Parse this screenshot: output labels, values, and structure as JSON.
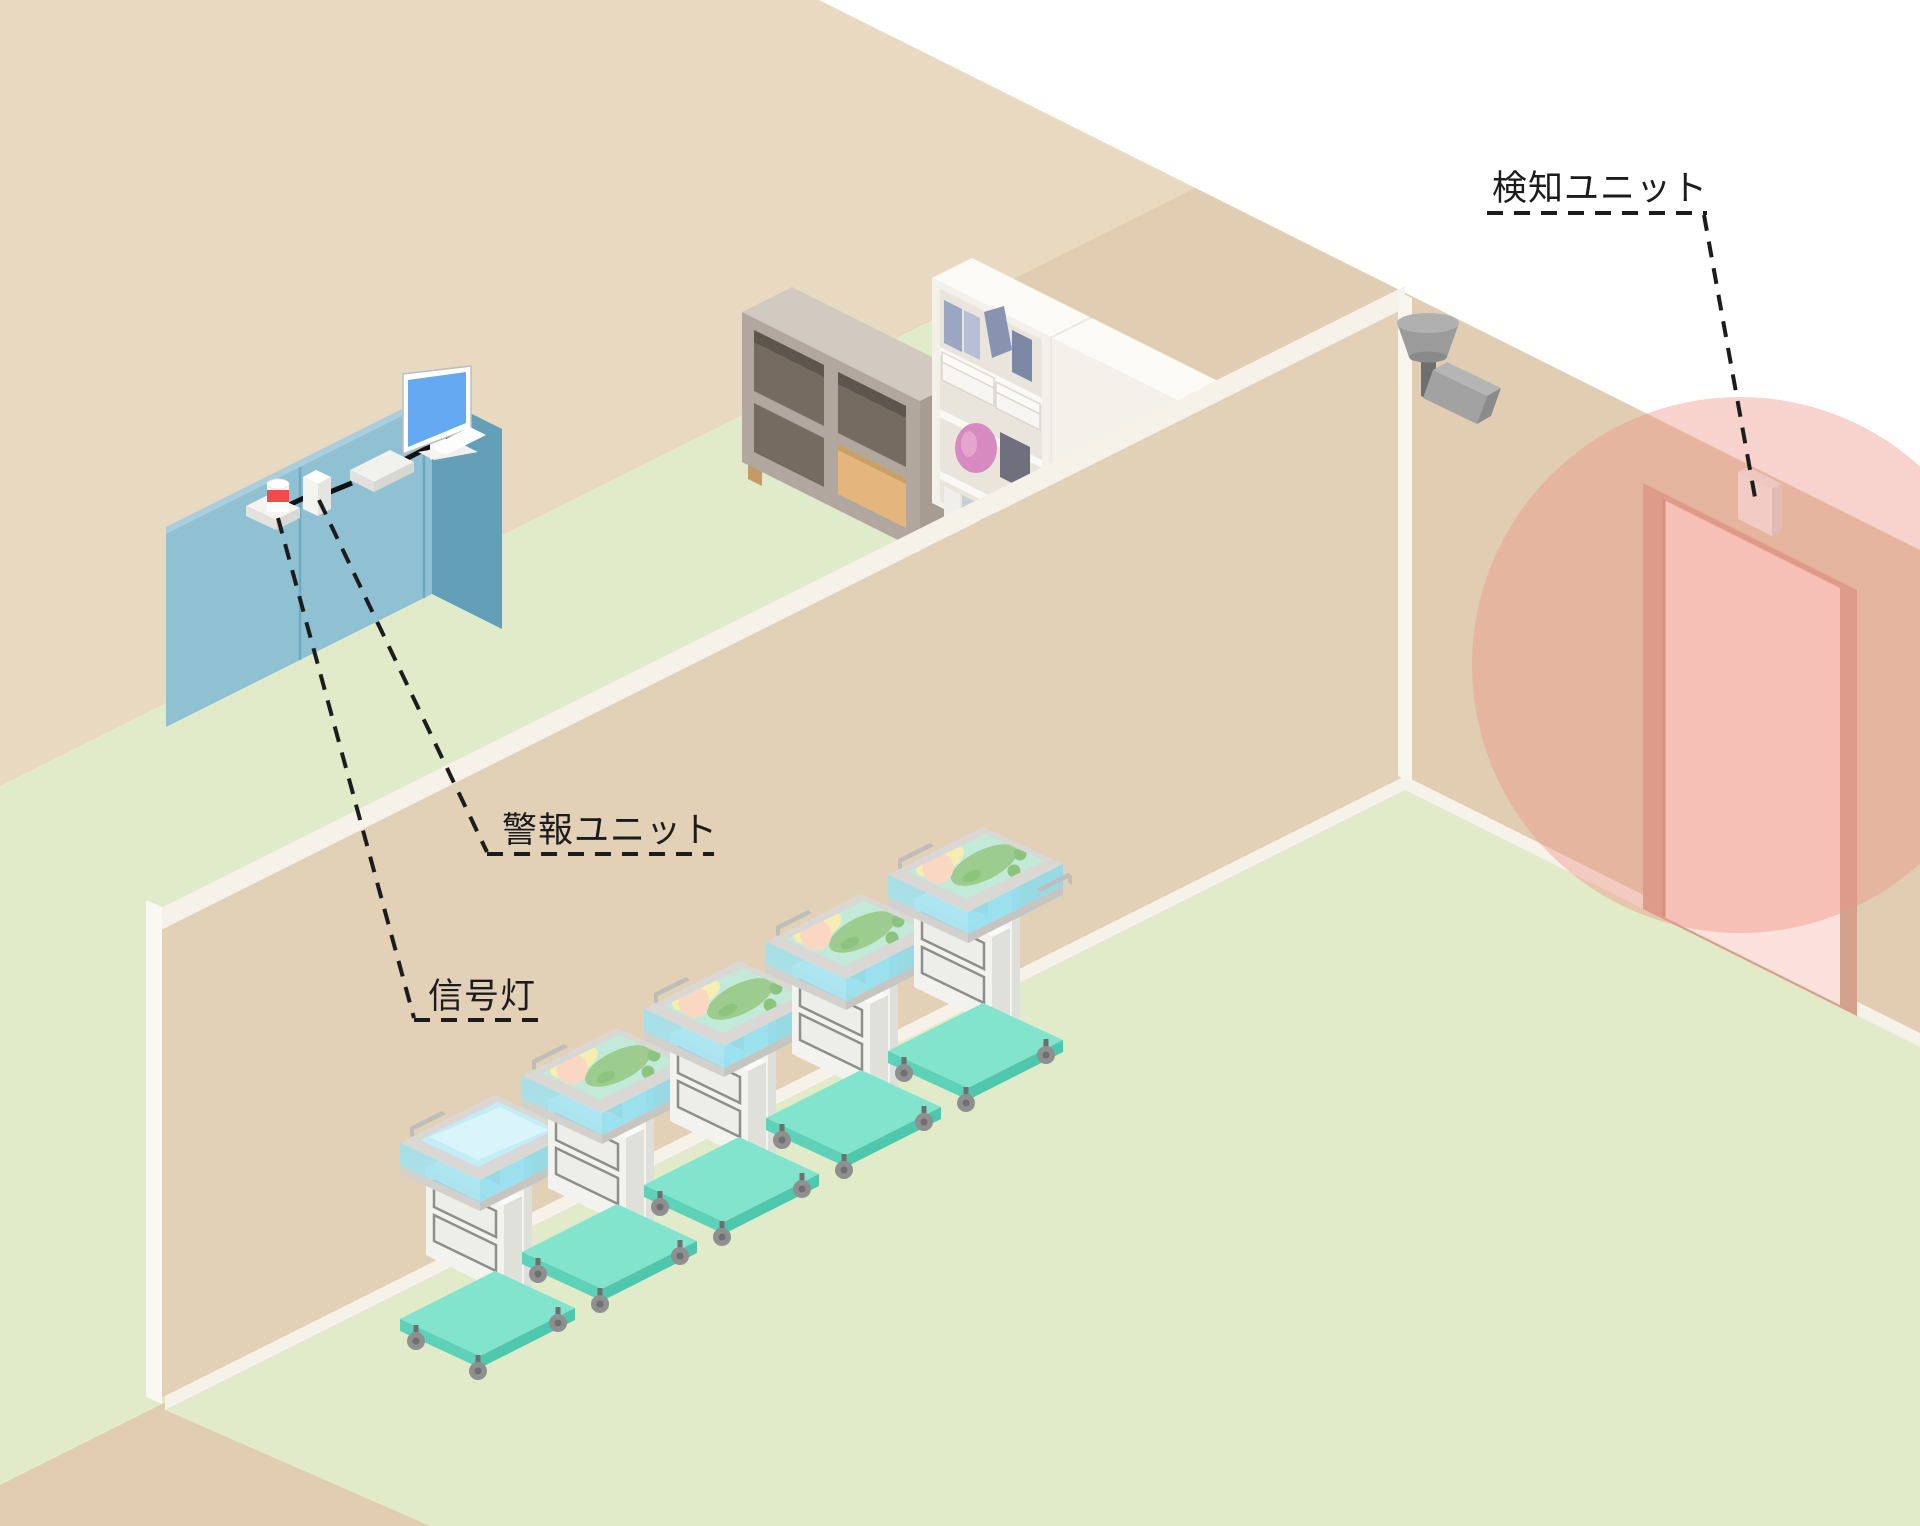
{
  "labels": {
    "detection_unit": "検知ユニット",
    "alarm_unit": "警報ユニット",
    "signal_light": "信号灯"
  },
  "colors": {
    "wall_base": "#e0cdb2",
    "wall_back": "#e9d9c1",
    "wall_partition": "#e3d1b7",
    "trim_white": "#f6f2e9",
    "floor_green": "#e1ebc9",
    "detection_zone": "#ef9486",
    "door_frame": "#d4a18d",
    "door_panel": "#fbe0db",
    "desk_top": "#c9dde5",
    "desk_front": "#8fc1d3",
    "desk_side": "#639fb7",
    "monitor_screen": "#66a9f3",
    "signal_red": "#f34a4a",
    "camera_gray": "#9b9b9b",
    "cart_teal": "#82e4cd",
    "cart_teal_dark": "#5ed2b8",
    "acrylic_cyan": "#9fe2ef",
    "baby_skin": "#f9d7c3",
    "baby_green": "#9ccd8e",
    "bedding_mint": "#c3ead9",
    "pillow_yellow": "#f6edb2",
    "shelf_gray": "#b2a79e",
    "shelf_wood": "#e4b57d",
    "bookshelf_white": "#f3f1ea",
    "vase_pink": "#d78abf",
    "line_black": "#1c1c1c"
  }
}
